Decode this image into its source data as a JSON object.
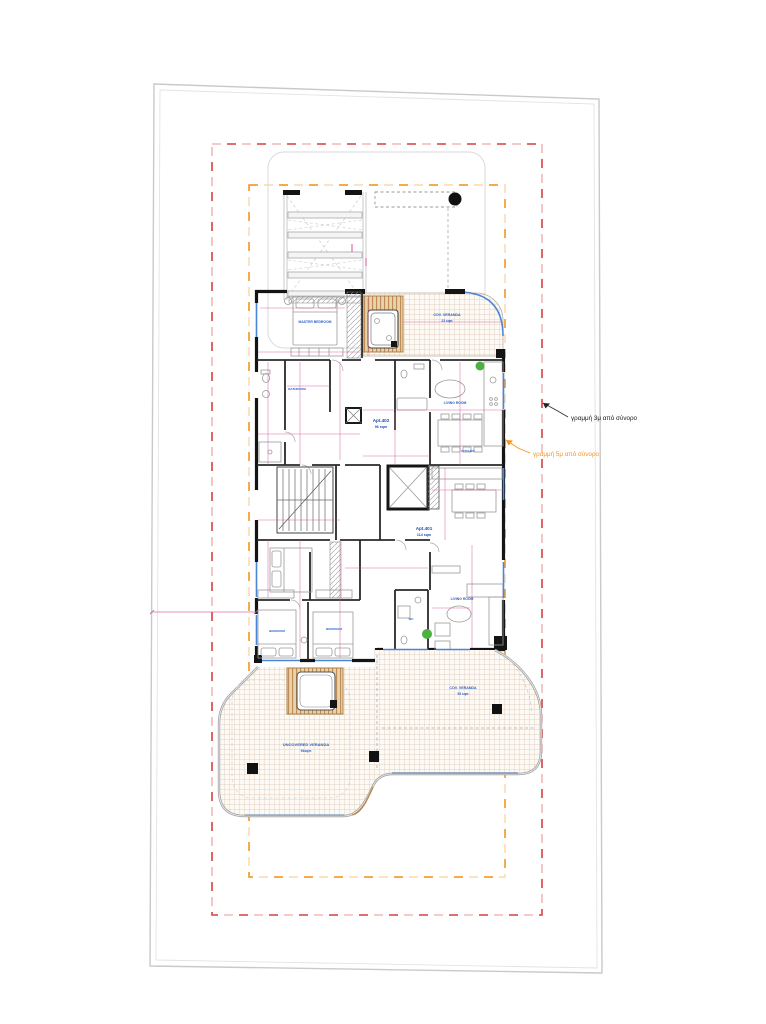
{
  "drawing": {
    "annotations": {
      "setback_3m": {
        "text": "γραμμή 3μ από σύνορο",
        "color": "#151515",
        "line_color": "#d94b4b"
      },
      "setback_5m": {
        "text": "γραμμή 5μ από σύνορο",
        "color": "#f5941e",
        "line_color": "#f5941e"
      }
    },
    "apartments": {
      "apt_402": {
        "name": "Apt.402",
        "area": "96 sqm"
      },
      "apt_401": {
        "name": "Apt.401",
        "area": "114 sqm"
      }
    },
    "verandas": {
      "top_covered": {
        "name": "COV. VERANDA",
        "area": "23 sqm"
      },
      "right_covered": {
        "name": "COV. VERANDA",
        "area": "55 sqm"
      },
      "uncovered": {
        "name": "UNCOVERED VERANDA",
        "area": "94sqm"
      }
    },
    "rooms": {
      "master_bedroom": "MASTER BEDROOM",
      "bathroom": "BATHROOM",
      "living_room_upper": "LIVING ROOM",
      "kitchen": "KITCHEN",
      "bedroom_left": "BEDROOM",
      "bedroom_right": "BEDROOM",
      "living_room_lower": "LIVING ROOM",
      "wc": "WC"
    },
    "colors": {
      "setback_red": "#d94b4b",
      "setback_orange": "#f5941e",
      "label_blue": "#2b5fc7",
      "dimension_pink": "#d4559e",
      "wall_black": "#141414",
      "glazing_blue": "#4a86d8",
      "veranda_grid_tan": "#d8c3ac",
      "wood_brown": "#b9854c",
      "plant_green": "#4db043",
      "site_boundary_gray": "#c9c9c9"
    }
  }
}
